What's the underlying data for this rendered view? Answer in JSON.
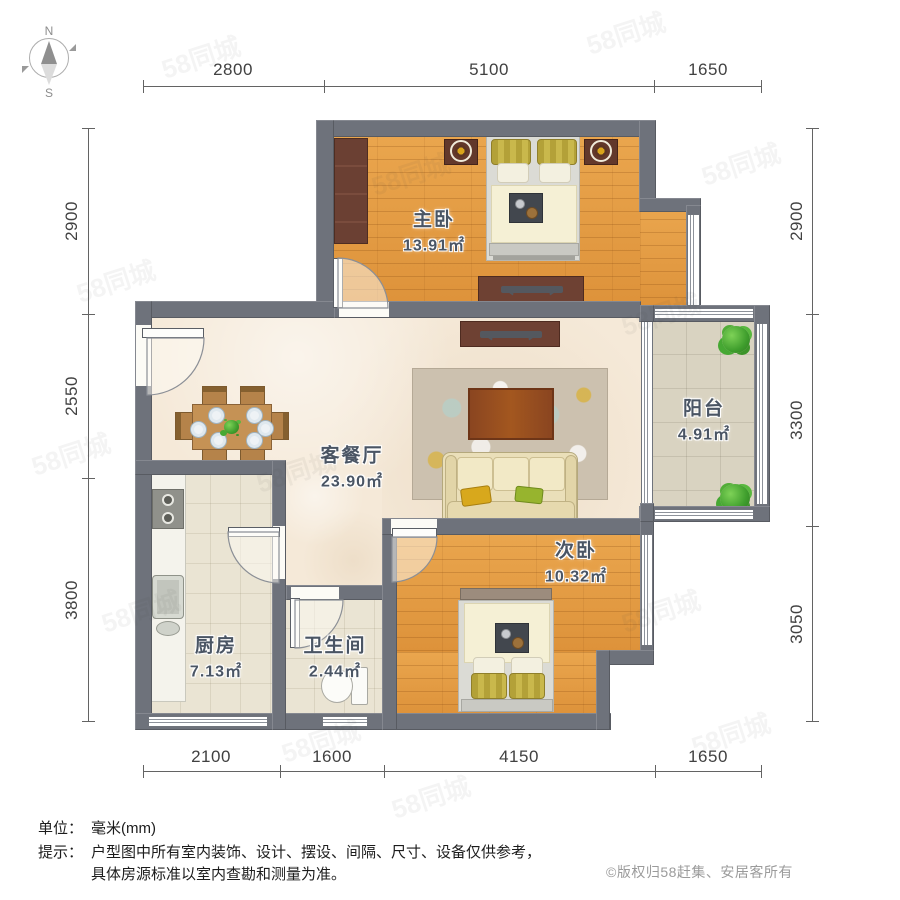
{
  "compass": {
    "north": "N",
    "south": "S"
  },
  "dimensions": {
    "top": [
      "2800",
      "5100",
      "1650"
    ],
    "bottom": [
      "2100",
      "1600",
      "4150",
      "1650"
    ],
    "left": [
      "2900",
      "2550",
      "3800"
    ],
    "right": [
      "2900",
      "3300",
      "3050"
    ]
  },
  "rooms": {
    "master": {
      "name": "主卧",
      "area": "13.91㎡"
    },
    "living": {
      "name": "客餐厅",
      "area": "23.90㎡"
    },
    "balcony": {
      "name": "阳台",
      "area": "4.91㎡"
    },
    "second": {
      "name": "次卧",
      "area": "10.32㎡"
    },
    "kitchen": {
      "name": "厨房",
      "area": "7.13㎡"
    },
    "bathroom": {
      "name": "卫生间",
      "area": "2.44㎡"
    }
  },
  "footer": {
    "unit_label": "单位：",
    "unit_value": "毫米(mm)",
    "tip_label": "提示：",
    "tip_line1": "户型图中所有室内装饰、设计、摆设、间隔、尺寸、设备仅供参考，",
    "tip_line2": "具体房源标准以室内查勘和测量为准。",
    "copyright": "©版权归58赶集、安居客所有"
  },
  "watermark": {
    "text": "58同城"
  },
  "colors": {
    "wall": "#6e727b",
    "wood_floor": "#e39a43",
    "living_floor": "#f5e9d8",
    "tile_floor": "#eae4d3",
    "balcony_floor": "#d9d3c1",
    "label_text": "#4a5564",
    "plant_green": "#3fa832"
  }
}
